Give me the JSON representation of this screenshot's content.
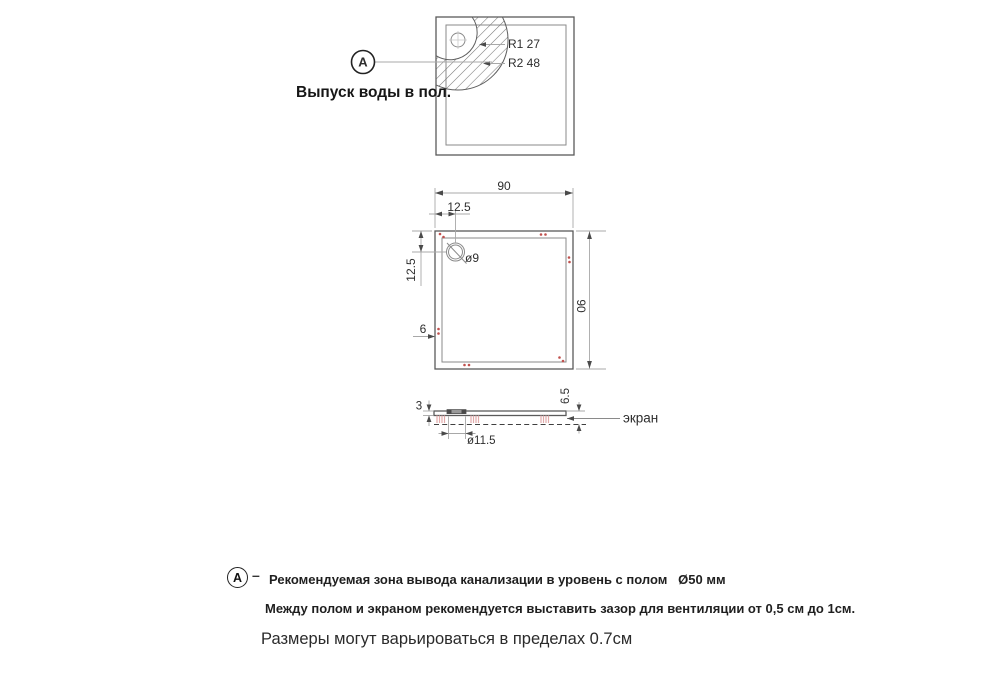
{
  "detail_view": {
    "callout_letter": "A",
    "caption": "Выпуск воды в пол.",
    "r1_label": "R1 27",
    "r2_label": "R2 48"
  },
  "plan_view": {
    "dim_width_top": "90",
    "dim_height_right": "90",
    "dim_drain_offset_x": "12.5",
    "dim_drain_offset_y": "12.5",
    "dim_bottom_left": "6",
    "drain_diameter_label": "ø9"
  },
  "side_view": {
    "dim_thickness": "3",
    "dim_edge_height": "6.5",
    "dim_flange_diameter": "ø11.5",
    "screen_label": "экран"
  },
  "notes": {
    "callout_letter": "A",
    "dash": "–",
    "line1": "Рекомендуемая зона вывода канализации в уровень с полом   Ø50 мм",
    "line2": "Между полом и экраном рекомендуется выставить зазор для вентиляции от 0,5 см до 1см.",
    "line3": "Размеры могут варьироваться в пределах 0.7см"
  },
  "colors": {
    "line_dark": "#5a5a5a",
    "line_light": "#a8a8a8",
    "text": "#2e2e2e",
    "accent_dots": "#c0504d",
    "hatch": "#787878",
    "pink_marks": "#e2abab"
  }
}
